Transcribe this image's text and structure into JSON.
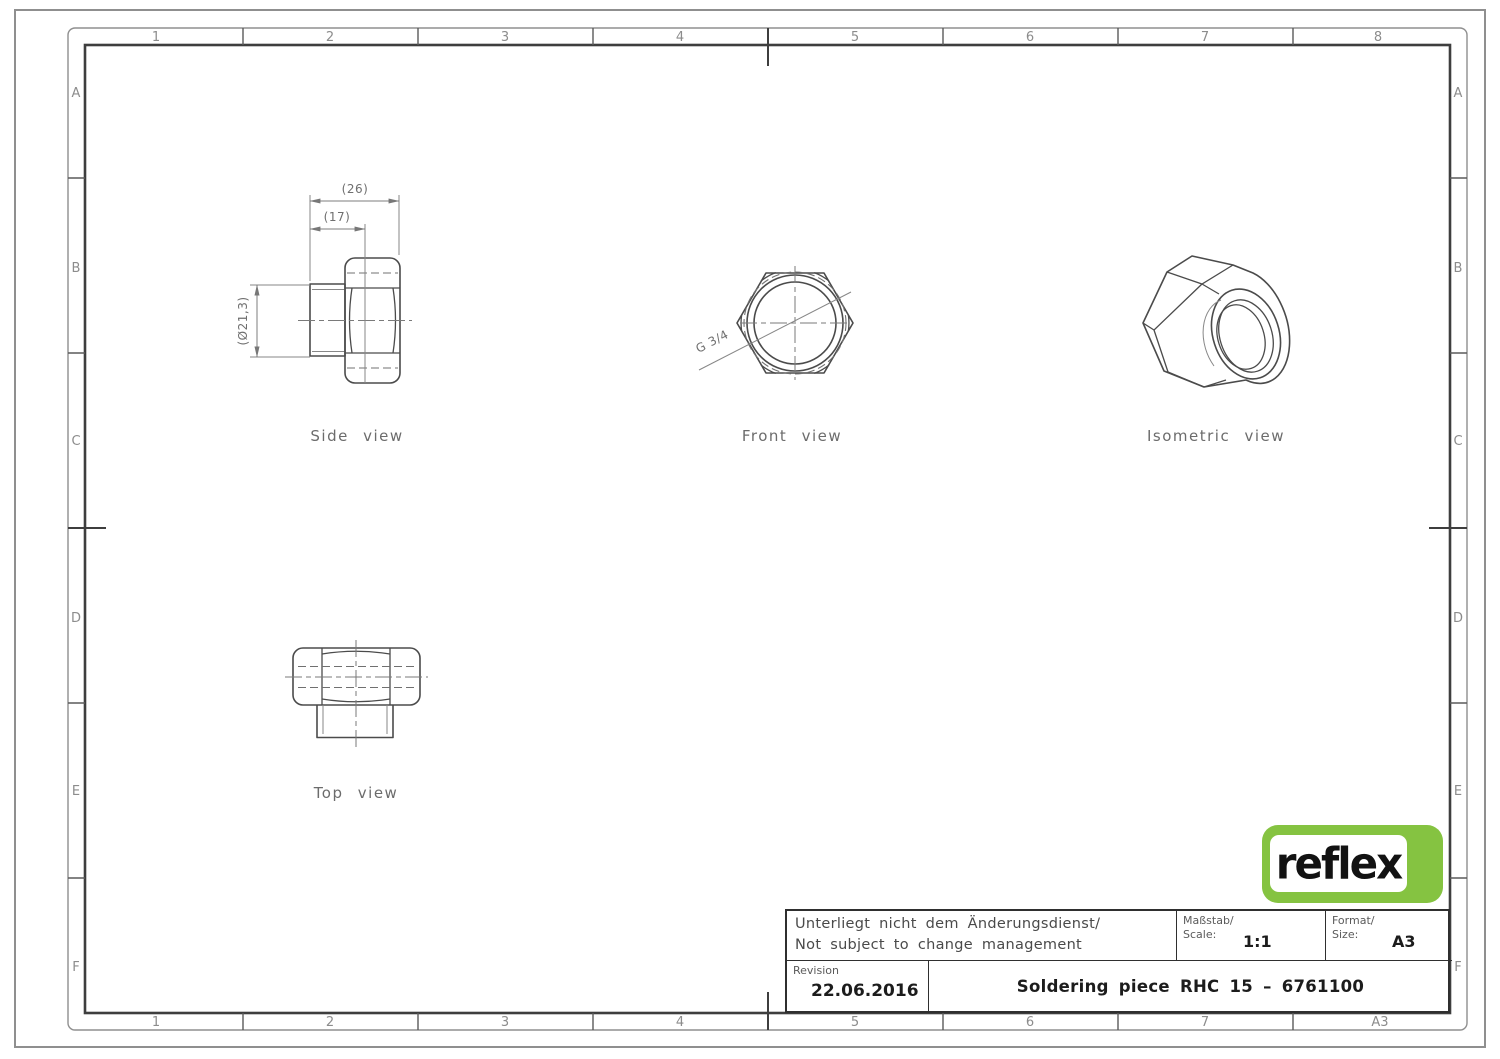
{
  "frame": {
    "columns_top": [
      "1",
      "2",
      "3",
      "4",
      "5",
      "6",
      "7",
      "8"
    ],
    "columns_bottom": [
      "1",
      "2",
      "3",
      "4",
      "5",
      "6",
      "7",
      "A3"
    ],
    "rows_left": [
      "A",
      "B",
      "C",
      "D",
      "E",
      "F"
    ],
    "rows_right": [
      "A",
      "B",
      "C",
      "D",
      "E",
      "F"
    ]
  },
  "views": {
    "side": {
      "label": "Side view",
      "dim_overall": "(26)",
      "dim_length": "(17)",
      "dim_diameter": "(Ø21,3)"
    },
    "front": {
      "label": "Front view",
      "thread_callout": "G 3/4"
    },
    "isometric": {
      "label": "Isometric view"
    },
    "top": {
      "label": "Top view"
    }
  },
  "title_block": {
    "note_de": "Unterliegt nicht dem Änderungsdienst/",
    "note_en": "Not subject to change management",
    "scale_label_de": "Maßstab/",
    "scale_label_en": "Scale:",
    "scale_value": "1:1",
    "format_label_de": "Format/",
    "format_label_en": "Size:",
    "format_value": "A3",
    "revision_label": "Revision",
    "revision_date": "22.06.2016",
    "title": "Soldering piece RHC 15 – 6761100"
  },
  "logo": {
    "text": "reflex",
    "green": "#85c341"
  },
  "colors": {
    "line_dark": "#4b4b4b",
    "line_thin": "#878787",
    "frame_border": "#3e3e3e"
  }
}
